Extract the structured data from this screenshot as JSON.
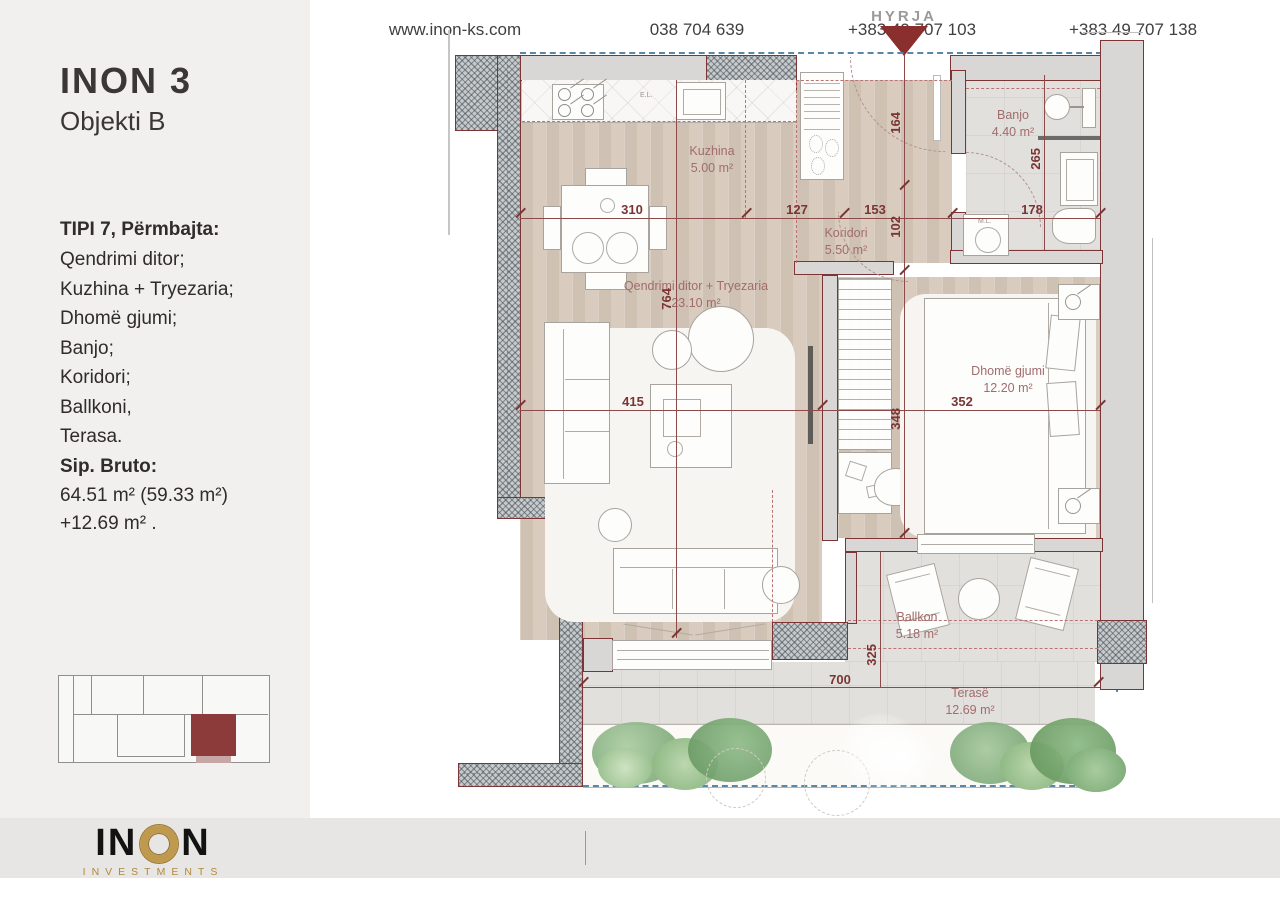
{
  "sidebar": {
    "title": "INON 3",
    "subtitle": "Objekti B",
    "contents_heading": "TIPI 7, Përmbajta:",
    "contents": [
      "Qendrimi ditor;",
      "Kuzhina + Tryezaria;",
      "Dhomë gjumi;",
      "Banjo;",
      "Koridori;",
      "Ballkoni,",
      "Terasa."
    ],
    "area_heading": "Sip. Bruto:",
    "area_line1": "64.51 m² (59.33 m²)",
    "area_line2": "+12.69 m² ."
  },
  "plan": {
    "entrance_label": "HYRJA",
    "rooms": [
      {
        "name": "Kuzhina",
        "area": "5.00 m²"
      },
      {
        "name": "Koridori",
        "area": "5.50 m²"
      },
      {
        "name": "Banjo",
        "area": "4.40 m²"
      },
      {
        "name": "Qendrimi ditor + Tryezaria",
        "area": "23.10 m²"
      },
      {
        "name": "Dhomë gjumi",
        "area": "12.20 m²"
      },
      {
        "name": "Ballkon",
        "area": "5.18 m²"
      },
      {
        "name": "Terasë",
        "area": "12.69 m²"
      }
    ],
    "dims": {
      "kitchen_width": "310",
      "corridor_left": "127",
      "corridor_mid": "153",
      "banjo_width": "178",
      "entry_depth": "164",
      "corridor_depth": "102",
      "banjo_depth": "265",
      "living_height": "764",
      "living_width": "415",
      "bedroom_width": "352",
      "bedroom_height": "348",
      "terrace_width": "700",
      "balcony_depth": "325"
    },
    "annotations": {
      "electrical": "E.L.",
      "washing_machine": "M.L."
    }
  },
  "footer": {
    "website": "www.inon-ks.com",
    "phone1": "038 704 639",
    "phone2": "+383 49 707 103",
    "phone3": "+383 49 707 138"
  },
  "logo": {
    "part1": "IN",
    "part2": "N",
    "sub": "INVESTMENTS"
  },
  "colors": {
    "wall_red": "#7c3434",
    "arrow_red": "#8a2e2e",
    "blue_dash": "#5a87a6",
    "gold": "#bf9a4e",
    "sidebar_bg": "#f1f0ee",
    "footer_bg": "#e7e6e4"
  }
}
